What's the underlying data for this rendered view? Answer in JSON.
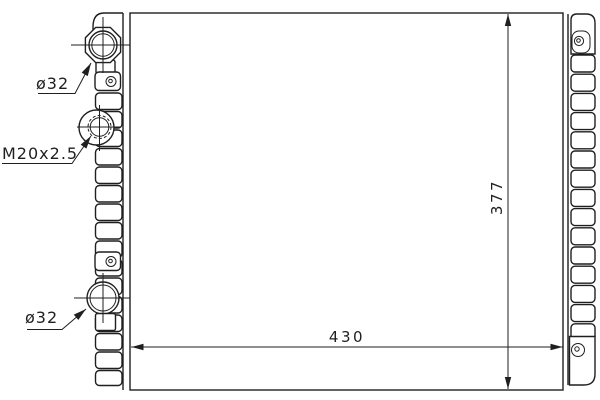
{
  "colors": {
    "line": "#1f1f1f",
    "background": "#ffffff"
  },
  "callouts": {
    "top_port_diameter": "ø32",
    "drain_plug_thread": "M20x2.5",
    "bottom_port_diameter": "ø32"
  },
  "dimensions": {
    "core_width": "430",
    "core_height": "377"
  }
}
